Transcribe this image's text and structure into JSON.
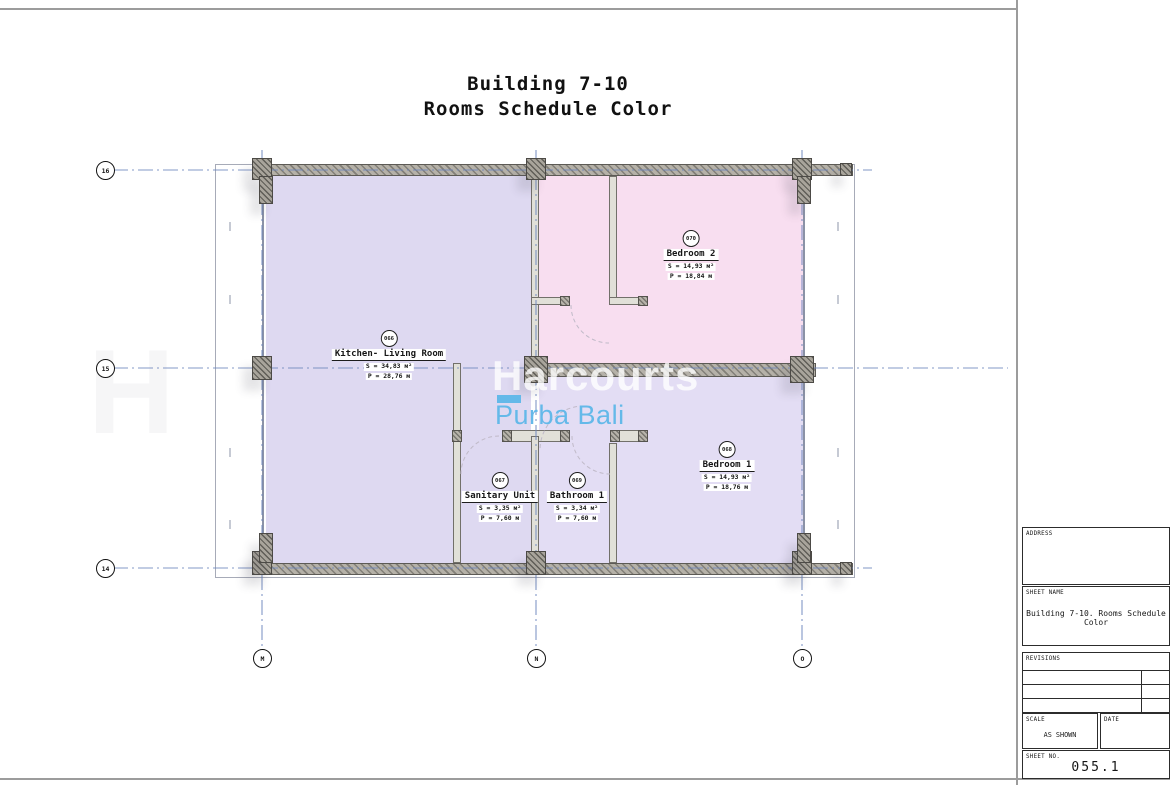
{
  "title": {
    "line1": "Building 7-10",
    "line2": "Rooms Schedule Color"
  },
  "watermark": {
    "brand": "Harcourts",
    "sub": "Purba Bali",
    "ghost": "H"
  },
  "grid": {
    "rows": [
      {
        "label": "16"
      },
      {
        "label": "15"
      },
      {
        "label": "14"
      }
    ],
    "cols": [
      {
        "label": "M"
      },
      {
        "label": "N"
      },
      {
        "label": "O"
      }
    ]
  },
  "rooms": [
    {
      "number": "066",
      "name": "Kitchen- Living Room",
      "area": "S = 34,83 м²",
      "perimeter": "P = 28,76 м"
    },
    {
      "number": "070",
      "name": "Bedroom 2",
      "area": "S = 14,93 м²",
      "perimeter": "P = 18,84 м"
    },
    {
      "number": "068",
      "name": "Bedroom 1",
      "area": "S = 14,93 м²",
      "perimeter": "P = 18,76 м"
    },
    {
      "number": "067",
      "name": "Sanitary Unit",
      "area": "S = 3,35 м²",
      "perimeter": "P = 7,60 м"
    },
    {
      "number": "069",
      "name": "Bathroom 1",
      "area": "S = 3,34 м²",
      "perimeter": "P = 7,60 м"
    }
  ],
  "title_block": {
    "address_label": "ADDRESS",
    "sheet_name_label": "SHEET NAME",
    "sheet_name_value": "Building 7-10. Rooms Schedule Color",
    "revisions_label": "REVISIONS",
    "scale_label": "SCALE",
    "scale_value": "AS SHOWN",
    "date_label": "DATE",
    "sheet_no_label": "SHEET NO.",
    "sheet_no_value": "055.1"
  },
  "colors": {
    "sheet-bg": "#ffffff",
    "line-gray": "#9c9c9c",
    "grid-blue": "#6d86bd",
    "outline": "#a7abb8",
    "room-lavender": "#ded9f1",
    "room-lavender2": "#e3ddf4",
    "room-pink": "#f8def0",
    "wall-base": "#b5b1a8",
    "wall-stripe": "#827f78",
    "col-base": "#a8a49b",
    "col-stripe": "#5f5d57",
    "part-fill": "#e1e0d8",
    "part-edge": "#72706a",
    "wm-blue": "#64b9e9",
    "wm-white": "rgba(255,255,255,0.78)",
    "ink": "#161616",
    "arc": "#c0bac8"
  }
}
